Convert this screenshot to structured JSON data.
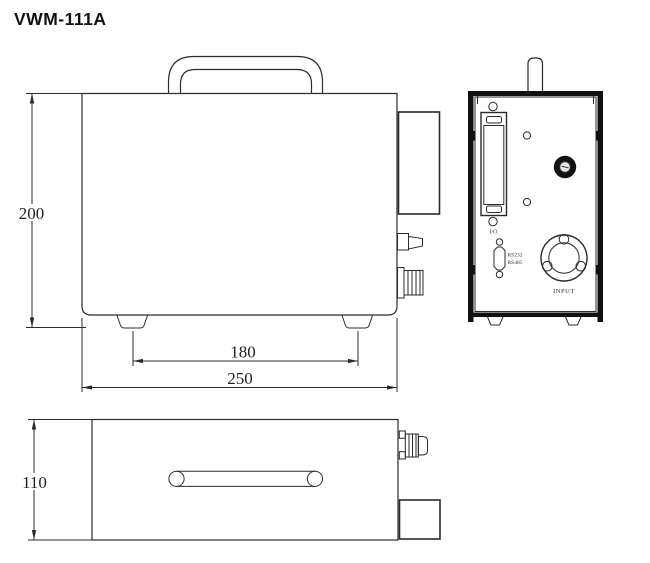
{
  "title": "VWM-111A",
  "colors": {
    "line": "#2b2b2b",
    "thick": "#111111",
    "label_text": "#4a3528",
    "dim_text": "#1f1f1f"
  },
  "front_view": {
    "dim_height": "200",
    "dim_feet": "180",
    "dim_width": "250"
  },
  "top_view": {
    "dim_depth": "110"
  },
  "side_view": {
    "label_io": "I/O",
    "label_rs232": "RS232",
    "label_rs485": "RS485",
    "label_input": "INPUT"
  }
}
